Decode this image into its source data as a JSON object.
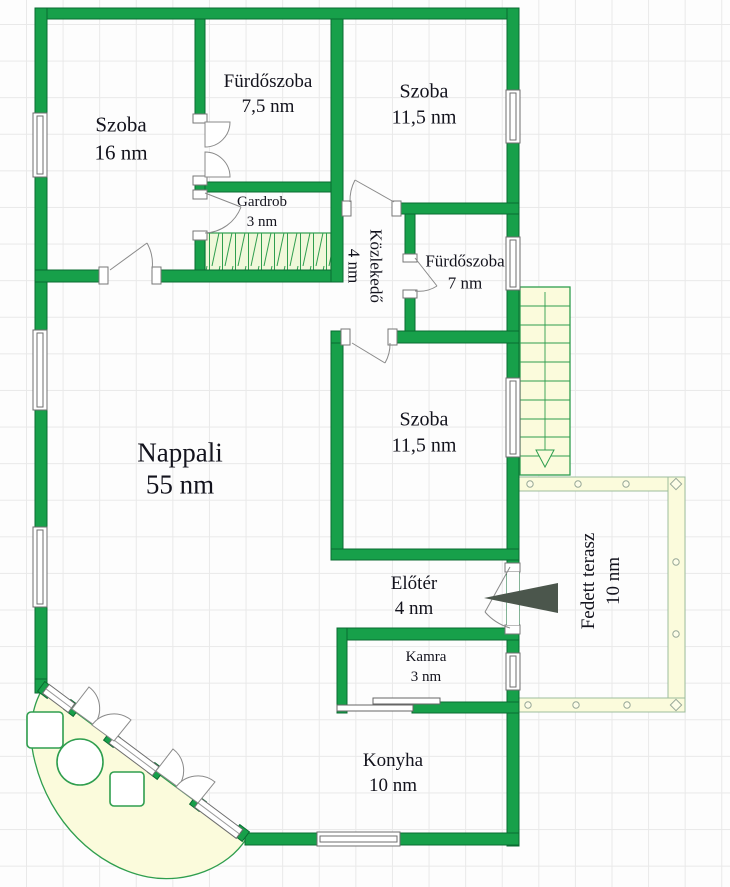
{
  "title": "Floor plan",
  "unit_suffix": "nm",
  "rooms": {
    "szoba_16": {
      "label": "Szoba",
      "area": "16 nm"
    },
    "furdoszoba_75": {
      "label": "Fürdőszoba",
      "area": "7,5 nm"
    },
    "szoba_115_top": {
      "label": "Szoba",
      "area": "11,5 nm"
    },
    "gardrob": {
      "label": "Gardrob",
      "area": "3 nm"
    },
    "kozlekedo": {
      "label": "Közlekedő",
      "area": "4 nm"
    },
    "furdoszoba_7": {
      "label": "Fürdőszoba",
      "area": "7 nm"
    },
    "szoba_115_mid": {
      "label": "Szoba",
      "area": "11,5 nm"
    },
    "nappali": {
      "label": "Nappali",
      "area": "55 nm"
    },
    "eloter": {
      "label": "Előtér",
      "area": "4 nm"
    },
    "fedett_terasz": {
      "label": "Fedett terasz",
      "area": "10 nm"
    },
    "kamra": {
      "label": "Kamra",
      "area": "3 nm"
    },
    "konyha": {
      "label": "Konyha",
      "area": "10 nm"
    }
  },
  "icons": {
    "entrance_arrow": "left-pointing-solid-triangle",
    "stairs_arrow": "down-arrow"
  },
  "colors": {
    "wall_fill": "#17a04a",
    "wall_border": "#0a6b31",
    "cream": "#fbfbdc",
    "outline_green": "#2f9e4e",
    "arrow_dark": "#4b564c",
    "grid": "#e9e9e9",
    "text": "#13131d"
  }
}
